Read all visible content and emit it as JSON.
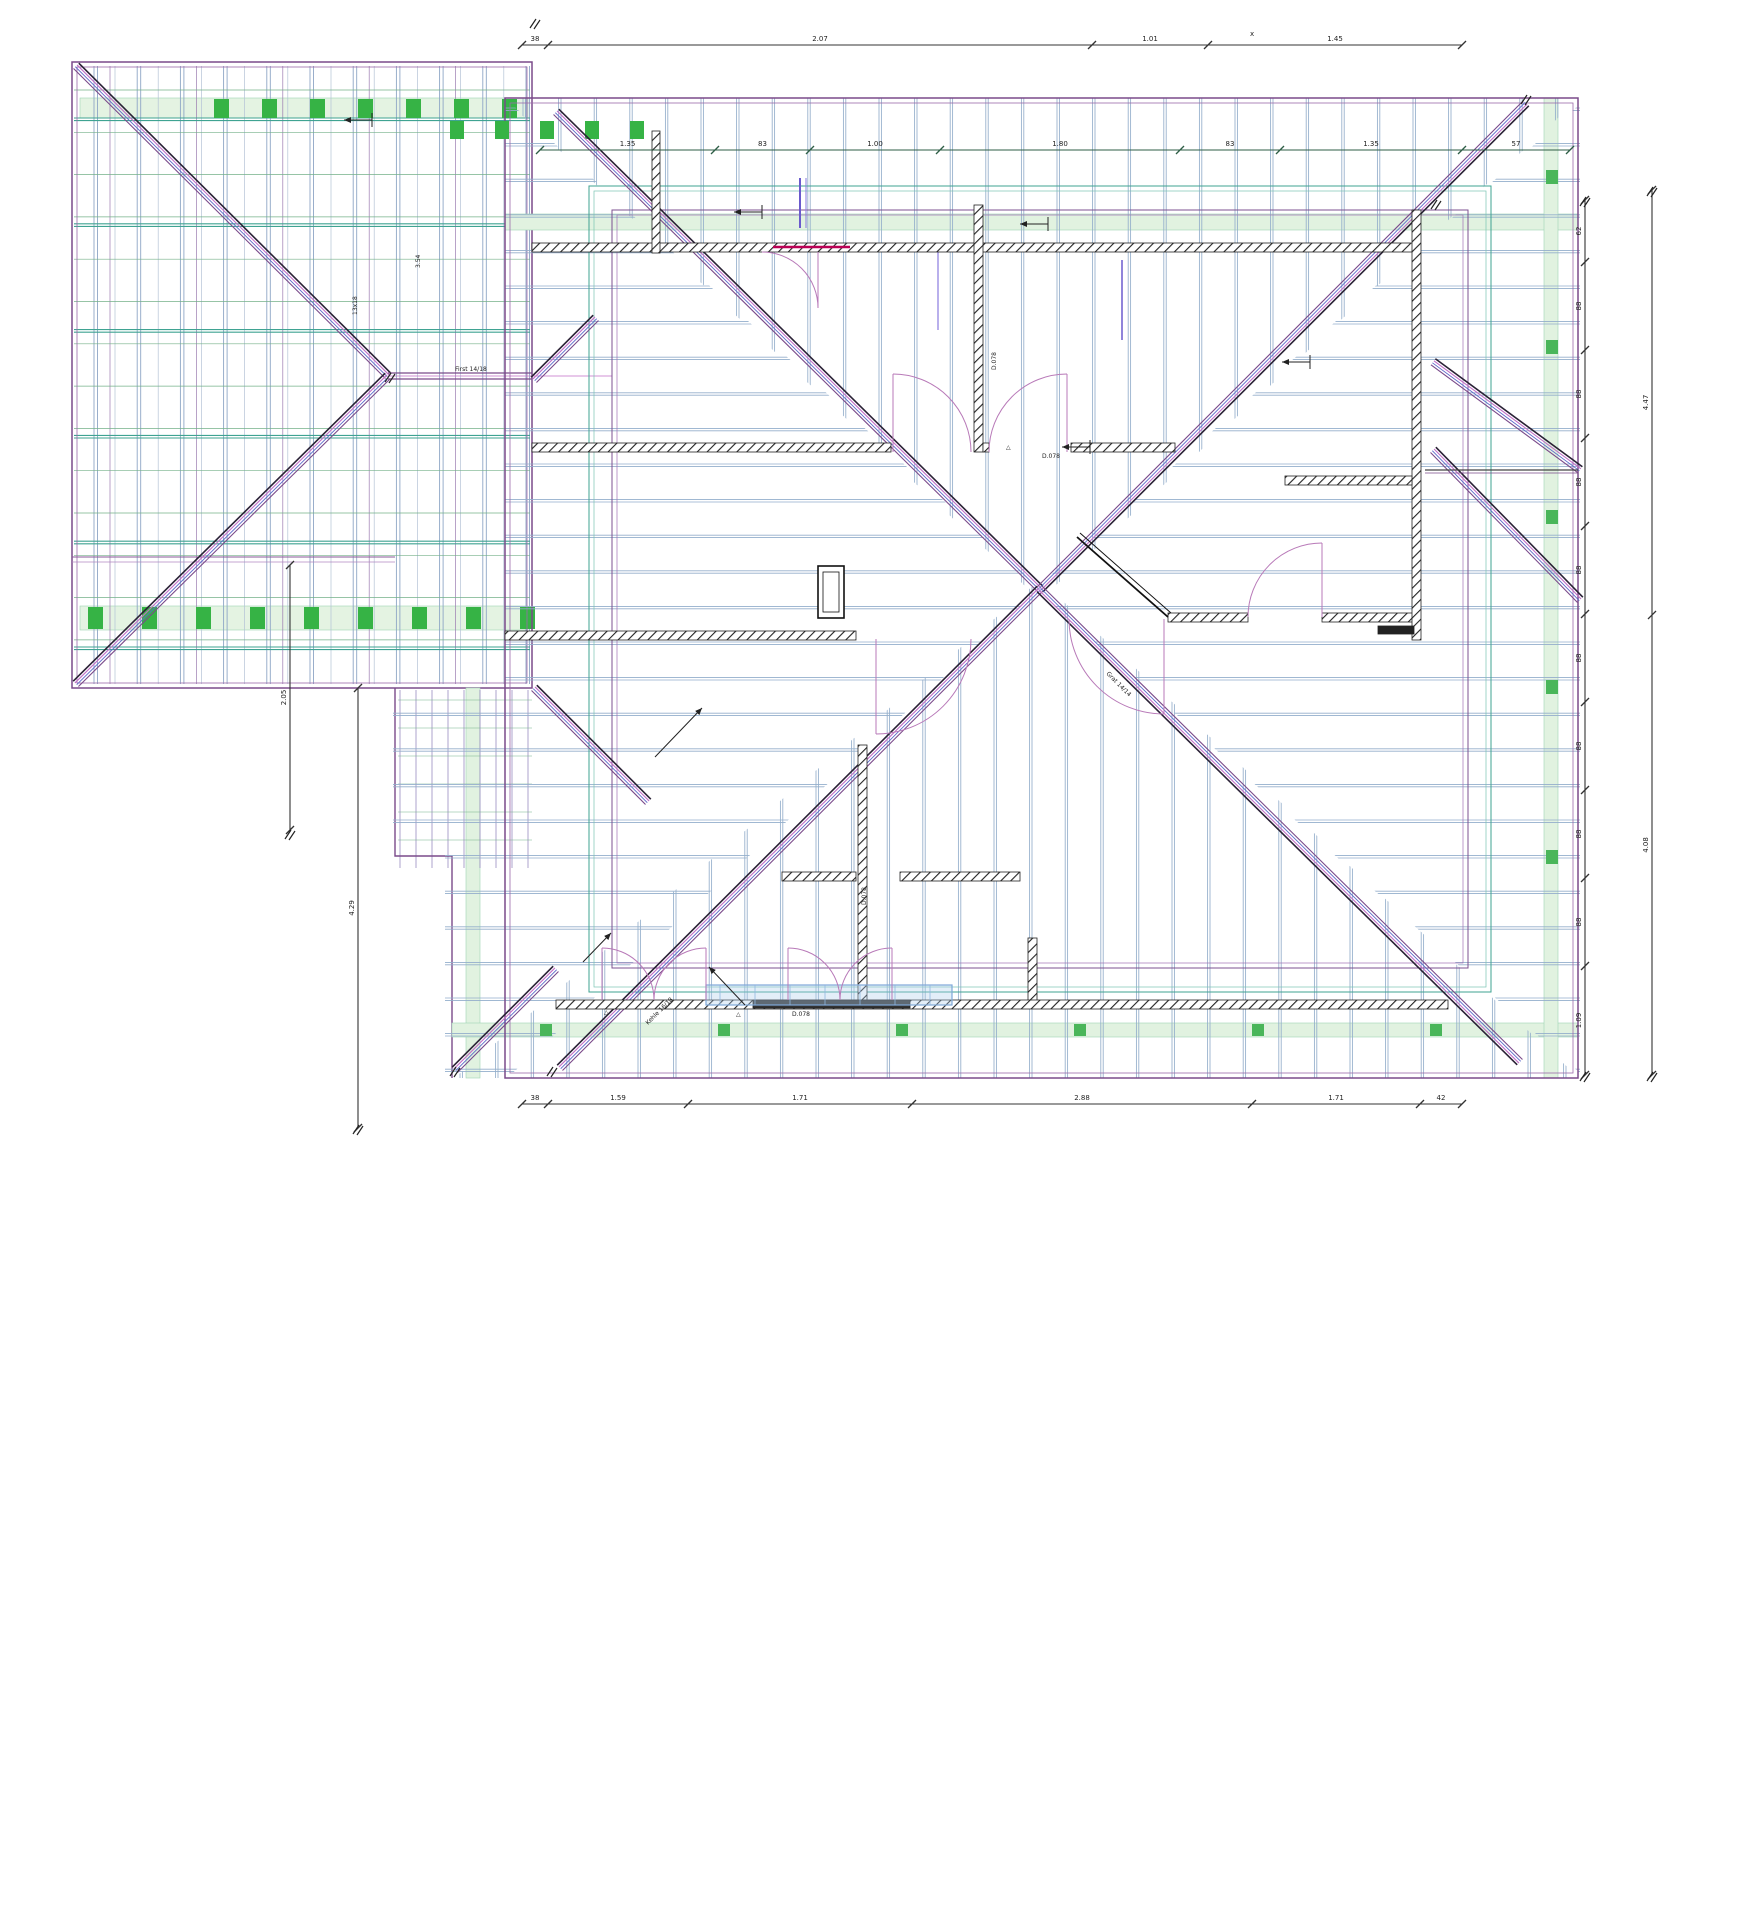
{
  "drawing": {
    "dimensions": {
      "top_outer": [
        "38",
        "2.07",
        "1.01",
        "1.45"
      ],
      "top_inner": [
        "1.35",
        "83",
        "1.00",
        "1.80",
        "83",
        "1.35",
        "57"
      ],
      "bottom": [
        "38",
        "1.59",
        "1.71",
        "2.88",
        "1.71",
        "42"
      ],
      "right_inner": [
        "62",
        "88",
        "88",
        "88",
        "88",
        "88",
        "88",
        "88",
        "88",
        "1.09"
      ],
      "right_outer": [
        "4.47",
        "4.08"
      ],
      "left_lower": [
        "2.05"
      ],
      "left_main": [
        "4.29"
      ],
      "wing_width": "3.54",
      "wing_beam": "13x18"
    },
    "labels": {
      "valley": "Kehle 16/18",
      "hip": "Grat 14/14",
      "ridge": "First 14/18",
      "beam_a": "D.078",
      "beam_b": "D.078",
      "beam_c": "D.078",
      "beam_d": "D.078",
      "marker": "△",
      "corner_mark": "x"
    },
    "colors": {
      "hip_purple": "#7a4a8a",
      "hip_dark": "#2a2136",
      "magenta": "#c06ec6",
      "blue": "#5b67c9",
      "rafter_blue": "#93aecb",
      "batten_green": "#3fa392",
      "grid_green": "#74b189",
      "light_green_fill": "#e1f2e0",
      "block_green": "#36b345",
      "wall_black": "#222222",
      "dim_black": "#333333",
      "door_arc": "#b879b8",
      "red_lintel": "#bb0055",
      "indigo": "#6a5acd",
      "light_blue": "#7fa8d8"
    }
  }
}
